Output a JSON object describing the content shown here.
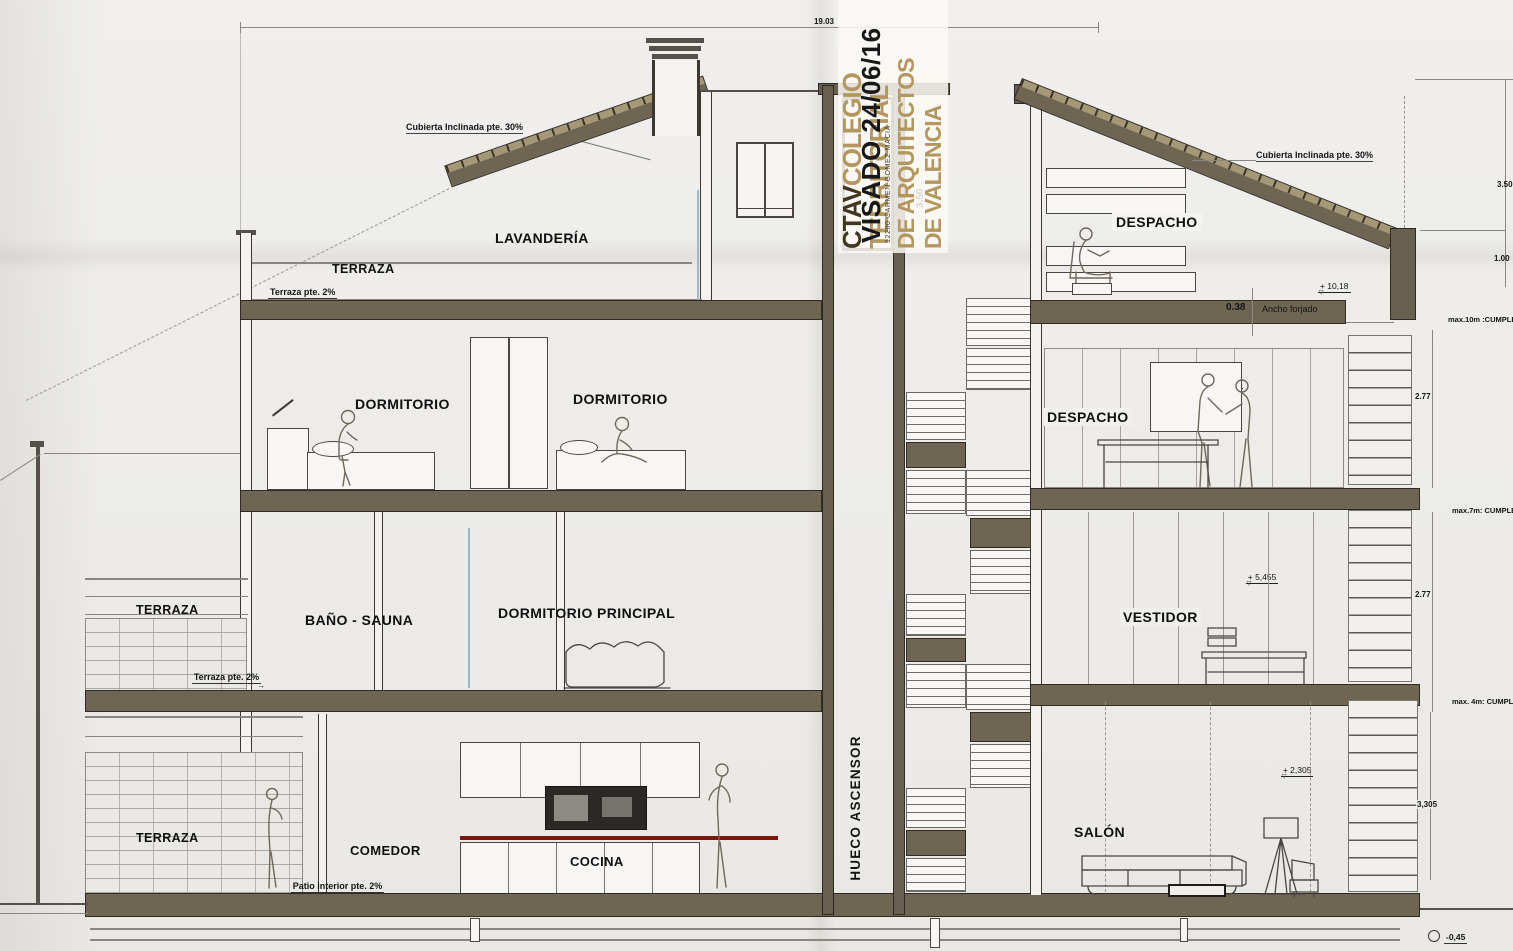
{
  "icons": {
    "level_marker": "▽",
    "slope_arrow": "→",
    "drain_circle": "◯"
  },
  "sheet": {
    "top_width_dim": "19.03",
    "hidden_dim": "3,50"
  },
  "stamp": {
    "org_bold": "CTAV",
    "org_word1": "COLEGIO",
    "org_word2": "TERRITORIAL",
    "org_word3": "DE ARQUITECTOS",
    "org_word4": "DE VALENCIA",
    "visado_line": "VISADO 24/06/16",
    "architect_line": "12200 CARMEN GÓMEZ MACIÁ"
  },
  "elevator": {
    "shaft_label": "HUECO ASCENSOR"
  },
  "left_wing": {
    "roof_note": "Cubierta Inclinada pte. 30%",
    "attic": {
      "terrace": "TERRAZA",
      "terrace_slope": "Terraza pte. 2%",
      "room": "LAVANDERÍA"
    },
    "floor2": {
      "bedroom_a": "DORMITORIO",
      "bedroom_b": "DORMITORIO"
    },
    "floor1": {
      "terrace": "TERRAZA",
      "bath": "BAÑO - SAUNA",
      "master": "DORMITORIO PRINCIPAL",
      "terrace_slope": "Terraza pte. 2%"
    },
    "floor0": {
      "terrace": "TERRAZA",
      "dining": "COMEDOR",
      "kitchen": "COCINA",
      "patio_slope": "Patio interior pte. 2%",
      "level": "+ 0,555"
    }
  },
  "right_wing": {
    "roof_note": "Cubierta Inclinada pte. 30%",
    "attic": {
      "room": "DESPACHO",
      "level_left": "+ 10,18",
      "level_right": "+ 10,18",
      "slab_dim": "0.38",
      "slab_label": "Ancho forjado"
    },
    "floor2": {
      "room": "DESPACHO",
      "level": "+ 7,03",
      "slope": "pte. 1.5%"
    },
    "floor1": {
      "room": "VESTIDOR",
      "level": "+ 3,88",
      "slope": "pte. 1.5%"
    },
    "floor0": {
      "room": "SALÓN",
      "level": "+ 0,205",
      "slope": "pte. 1%"
    }
  },
  "stairs": {
    "level_3": "+ 8,605",
    "level_2": "+ 5,455",
    "level_1": "+ 2,305"
  },
  "margin": {
    "lvl_1368": "+ 13,68",
    "dim_roof": "3.50",
    "lvl_1118": "+ 11,18",
    "dim_eave": "1.00",
    "lvl_1018": "+ 10,18 (nivel pvto.)",
    "lvl_980_l1": "+ 9,80 (Alt.cornisa",
    "lvl_980_l2": "max.10m :CUMPLE)",
    "dim_f3": "2.77",
    "lvl_665_l1": "+ 6,65 (Alt.cornisa",
    "lvl_665_l2": "max.7m: CUMPLE)",
    "dim_f2": "2.77",
    "lvl_350_l1": "+ 3,50 (Alt.cornisa",
    "lvl_350_l2": "max. 4m: CUMPLE)",
    "dim_f1": "3,305",
    "lvl_0195": "+ 0,195",
    "lvl_000": "±0,00",
    "lvl_m045": "-0,45"
  }
}
